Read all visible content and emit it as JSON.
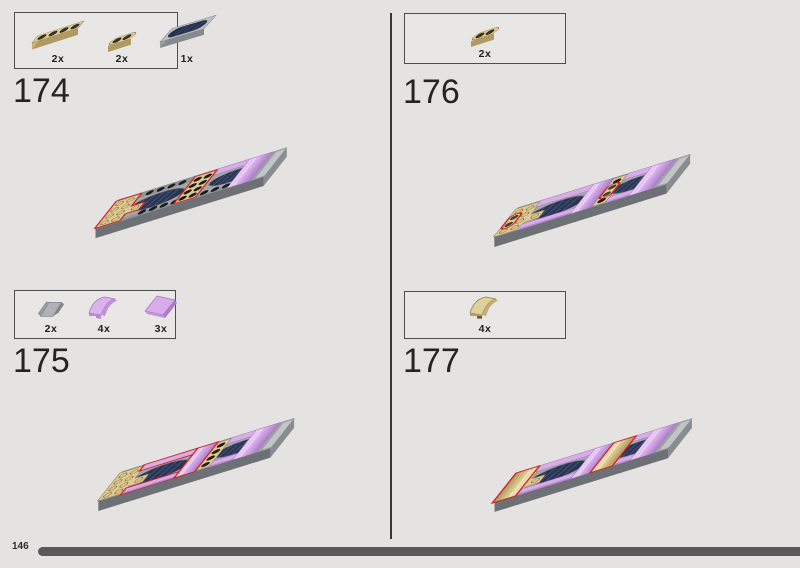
{
  "page": {
    "number": "146"
  },
  "steps": [
    {
      "number": "174",
      "parts": [
        {
          "qty": "2x",
          "name": "plate-1x4-tan"
        },
        {
          "qty": "2x",
          "name": "plate-1x2-rounded-tan"
        },
        {
          "qty": "1x",
          "name": "tile-2x4-dark-blue-print"
        }
      ]
    },
    {
      "number": "175",
      "parts": [
        {
          "qty": "2x",
          "name": "slope-1x1-gray"
        },
        {
          "qty": "4x",
          "name": "curved-slope-1x2-lavender"
        },
        {
          "qty": "3x",
          "name": "slope-tile-2x2-lavender"
        }
      ]
    },
    {
      "number": "176",
      "parts": [
        {
          "qty": "2x",
          "name": "plate-1x2-rounded-tan"
        }
      ]
    },
    {
      "number": "177",
      "parts": [
        {
          "qty": "4x",
          "name": "curved-slope-1x2-tan"
        }
      ]
    }
  ],
  "colors": {
    "background": "#e4e3e2",
    "highlight_red": "#cf1f1f",
    "tan": "#dcc993",
    "lavender": "#d8ace9",
    "gray_piece": "#a3a6a9",
    "dark_print_navy": "#2b3450",
    "progress_bar": "#59595b"
  }
}
